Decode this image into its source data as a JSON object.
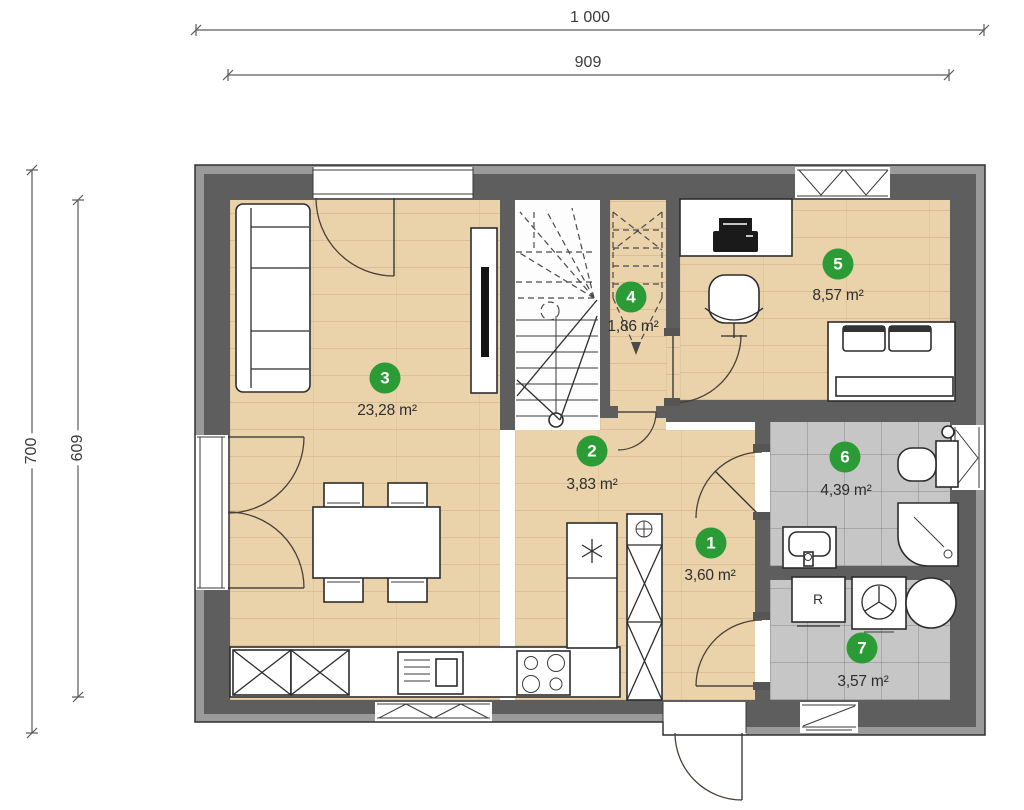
{
  "plan_title": "floor-plan-ground-floor",
  "dimensions": {
    "top_outer": "1 000",
    "top_inner": "909",
    "left_outer": "700",
    "left_inner": "609"
  },
  "rooms": [
    {
      "number": "1",
      "area": "3,60 m²"
    },
    {
      "number": "2",
      "area": "3,83 m²"
    },
    {
      "number": "3",
      "area": "23,28 m²"
    },
    {
      "number": "4",
      "area": "1,86 m²"
    },
    {
      "number": "5",
      "area": "8,57 m²"
    },
    {
      "number": "6",
      "area": "4,39 m²"
    },
    {
      "number": "7",
      "area": "3,57 m²"
    }
  ],
  "labels": {
    "utility_appliance": "R"
  },
  "colors": {
    "badge_green": "#2a9b35",
    "wall": "#5e5e5e",
    "wall_outer": "#9a9a9a",
    "wood": "#ead2ab",
    "tile": "#c6c6c6"
  }
}
